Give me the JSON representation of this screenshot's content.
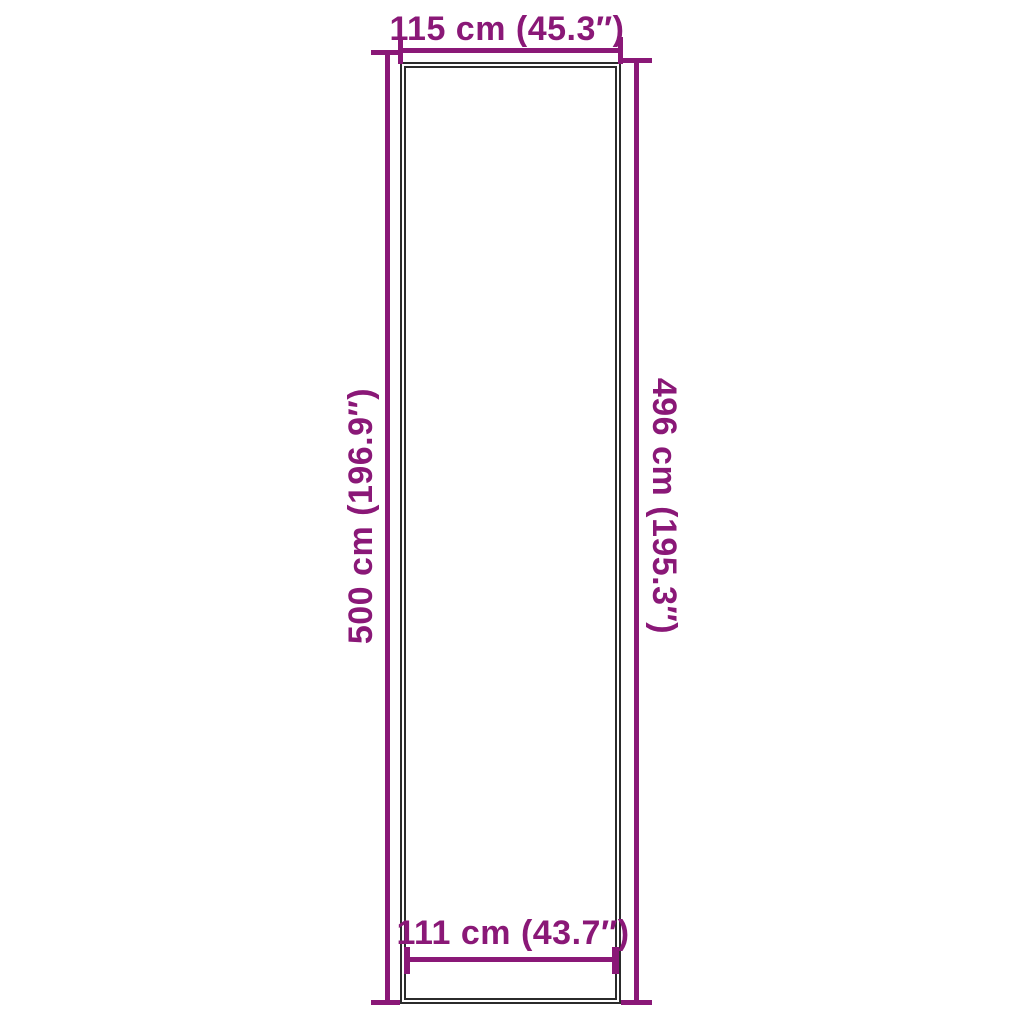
{
  "diagram": {
    "kind": "product-dimension-diagram",
    "background_color": "#ffffff",
    "accent_color": "#8A1877",
    "outline_color": "#2b2b2b",
    "dimensions": {
      "top": {
        "label": "115 cm (45.3″)"
      },
      "left": {
        "label": "500 cm (196.9″)"
      },
      "right": {
        "label": "496 cm (195.3″)"
      },
      "bottom": {
        "label": "111 cm (43.7″)"
      }
    }
  }
}
